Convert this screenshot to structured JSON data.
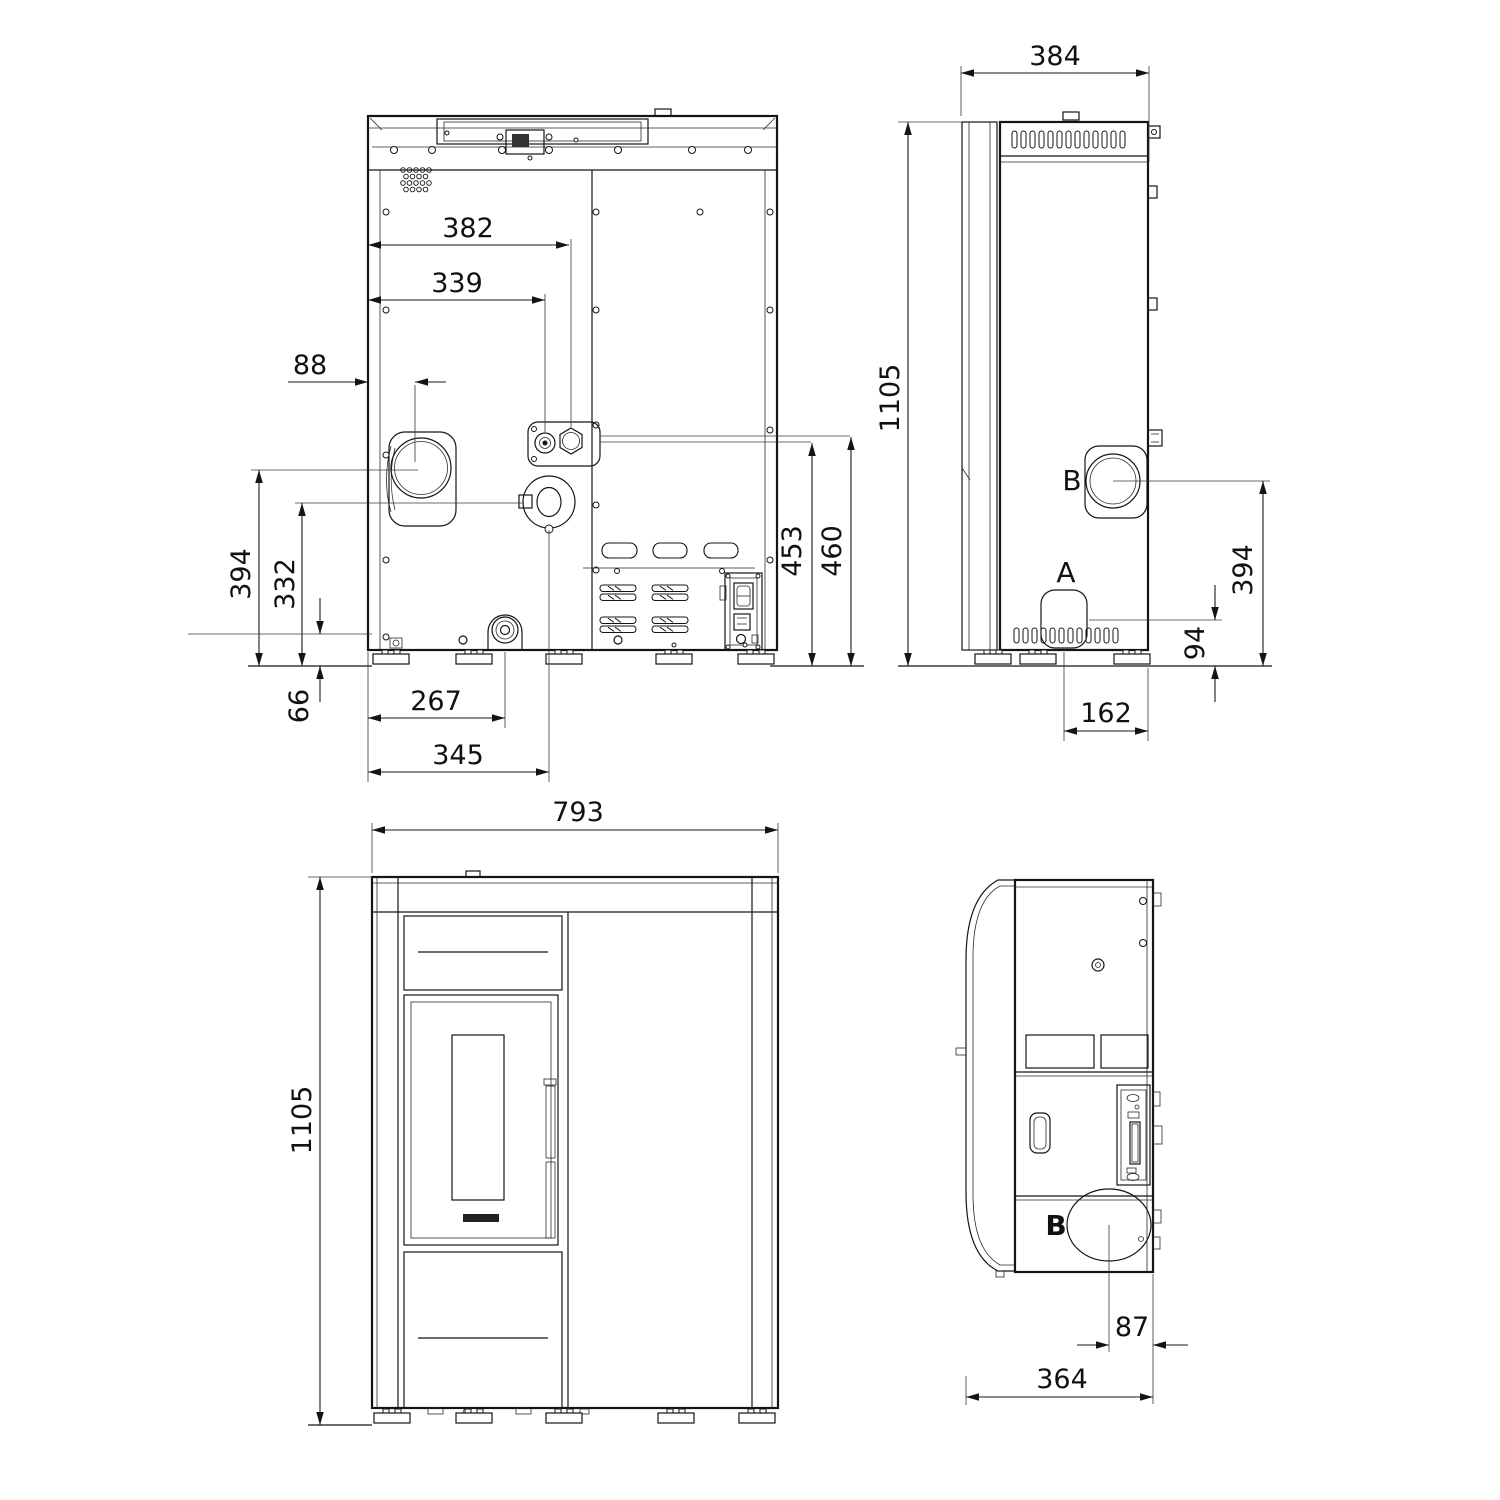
{
  "rear": {
    "d382": "382",
    "d339": "339",
    "d88": "88",
    "d394": "394",
    "d332": "332",
    "d66": "66",
    "d267": "267",
    "d345": "345",
    "d453": "453",
    "d460": "460"
  },
  "side_top": {
    "d384": "384",
    "d1105": "1105",
    "d394": "394",
    "d94": "94",
    "d162": "162",
    "label_a": "A",
    "label_b": "B"
  },
  "front": {
    "d793": "793",
    "d1105": "1105"
  },
  "side_bottom": {
    "d87": "87",
    "d364": "364",
    "label_b": "B"
  }
}
